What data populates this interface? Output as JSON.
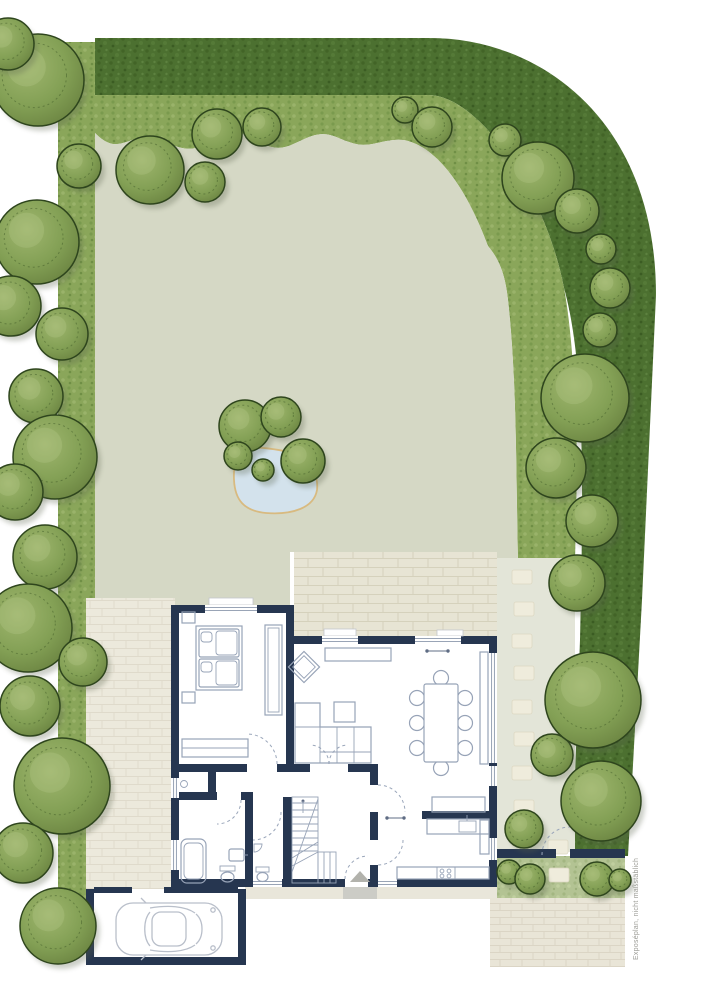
{
  "annotation": {
    "text": "Exposéplan, nicht maßstäblich"
  },
  "palette": {
    "wall": "#263650",
    "lawn": "#d5d8c5",
    "hedge_dark": "#4c7030",
    "shrub_band": "#8aa65a",
    "bottom_strip": "#b3c393",
    "tree_outline": "#2e451d",
    "tree_fill": "#83a055",
    "terrace_paving": "#e7e4d4",
    "side_path_paving": "#ece9dc",
    "street_paving": "#e9e5d7",
    "garden_path": "#e3e5d8",
    "stepping_stone": "#efecdc",
    "pond_water": "#d3e2ec",
    "pond_edge": "#d8ba80",
    "furniture_line": "#97a3b7",
    "car_line": "#b9bfca",
    "note_text": "#9b9b95",
    "concrete": "#e9e6da"
  },
  "garden": {
    "trees": [
      [
        38,
        80,
        46
      ],
      [
        8,
        44,
        26
      ],
      [
        150,
        170,
        34
      ],
      [
        205,
        182,
        20
      ],
      [
        79,
        166,
        22
      ],
      [
        37,
        242,
        42
      ],
      [
        11,
        306,
        30
      ],
      [
        62,
        334,
        26
      ],
      [
        36,
        396,
        27
      ],
      [
        55,
        457,
        42
      ],
      [
        15,
        492,
        28
      ],
      [
        45,
        557,
        32
      ],
      [
        28,
        628,
        44
      ],
      [
        83,
        662,
        24
      ],
      [
        30,
        706,
        30
      ],
      [
        62,
        786,
        48
      ],
      [
        23,
        853,
        30
      ],
      [
        58,
        926,
        38
      ],
      [
        217,
        134,
        25
      ],
      [
        262,
        127,
        19
      ],
      [
        405,
        110,
        13
      ],
      [
        432,
        127,
        20
      ],
      [
        505,
        140,
        16
      ],
      [
        538,
        178,
        36
      ],
      [
        577,
        211,
        22
      ],
      [
        601,
        249,
        15
      ],
      [
        610,
        288,
        20
      ],
      [
        600,
        330,
        17
      ],
      [
        585,
        398,
        44
      ],
      [
        556,
        468,
        30
      ],
      [
        592,
        521,
        26
      ],
      [
        577,
        583,
        28
      ],
      [
        552,
        755,
        21
      ],
      [
        593,
        700,
        48
      ],
      [
        601,
        801,
        40
      ],
      [
        524,
        829,
        19
      ],
      [
        245,
        426,
        26
      ],
      [
        281,
        417,
        20
      ],
      [
        238,
        456,
        14
      ],
      [
        303,
        461,
        22
      ],
      [
        263,
        470,
        11
      ],
      [
        509,
        872,
        12
      ],
      [
        530,
        879,
        15
      ],
      [
        597,
        879,
        17
      ],
      [
        620,
        880,
        11
      ]
    ],
    "stepping_stones": [
      [
        512,
        570
      ],
      [
        514,
        602
      ],
      [
        512,
        634
      ],
      [
        514,
        666
      ],
      [
        512,
        700
      ],
      [
        514,
        732
      ],
      [
        512,
        766
      ],
      [
        514,
        800
      ],
      [
        512,
        832
      ],
      [
        548,
        840
      ],
      [
        549,
        868
      ]
    ]
  }
}
